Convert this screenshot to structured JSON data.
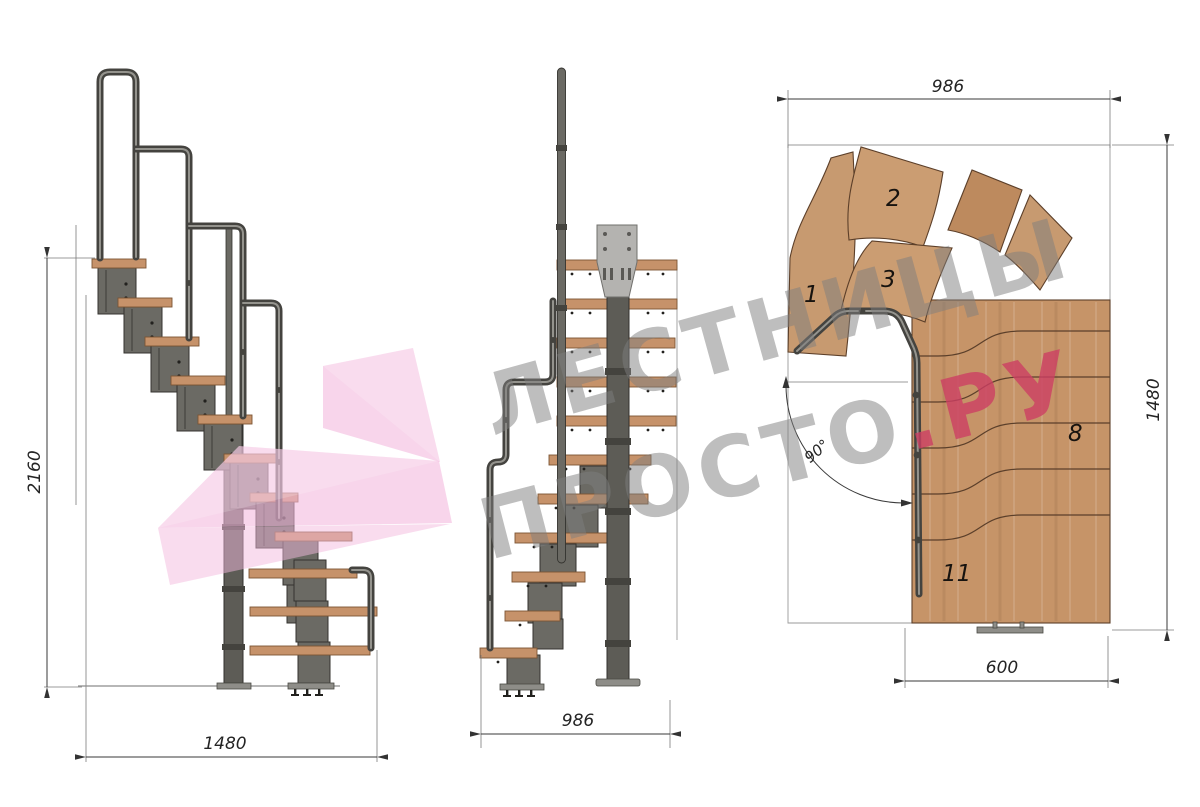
{
  "drawing": {
    "side_view": {
      "dim_height": "2160",
      "dim_length": "1480"
    },
    "front_view": {
      "dim_width": "986"
    },
    "plan_view": {
      "dim_width": "986",
      "dim_depth": "1480",
      "dim_exit": "600",
      "angle": "90°",
      "step_numbers": {
        "n1": "1",
        "n2": "2",
        "n3": "3",
        "n8": "8",
        "n11": "11"
      }
    }
  },
  "watermark": {
    "line1": "ЛЕСТНИЦЫ",
    "line2": "ПРОСТО",
    "suffix": ".РУ",
    "text_color": "#7d7d7d",
    "accent_color": "#cc3f63",
    "arrow_color": "#f3b9dd"
  },
  "palette": {
    "wood": "#c6926a",
    "wood_dark": "#7c5534",
    "metal": "#6b6a64",
    "metal_dark": "#34332f",
    "plate": "#b4b3b0",
    "dim_line": "#3a3a3a",
    "background": "#ffffff"
  }
}
